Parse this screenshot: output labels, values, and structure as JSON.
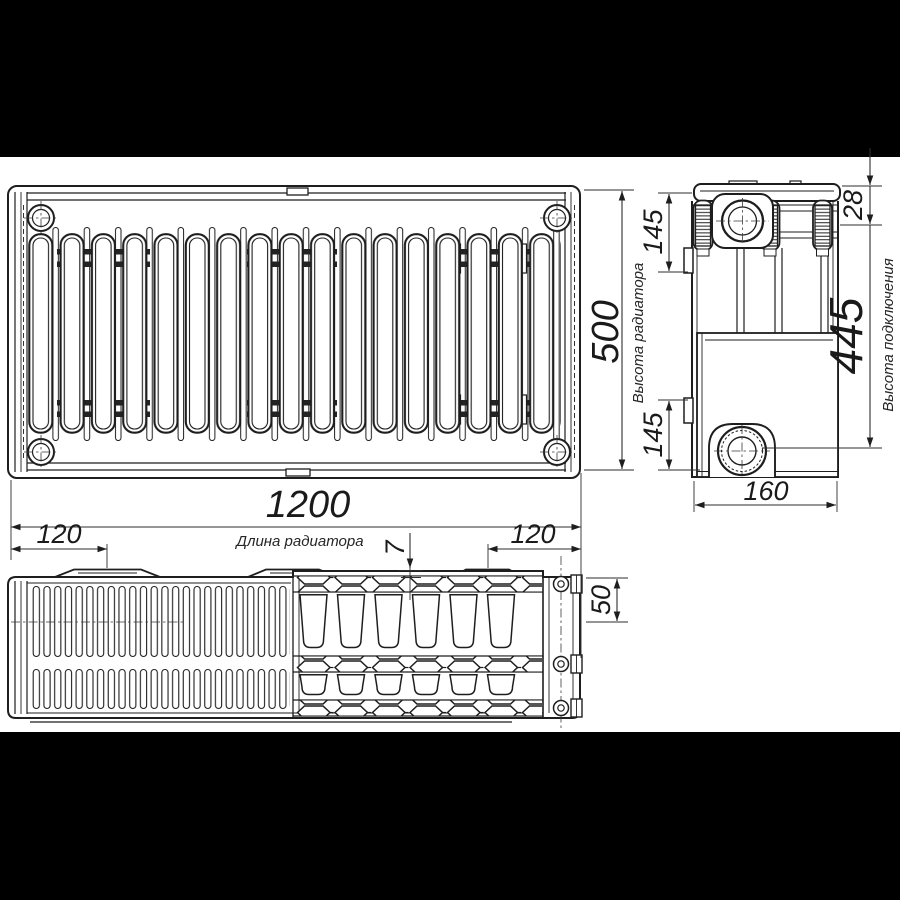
{
  "colors": {
    "backdrop": "#000000",
    "paper": "#ffffff",
    "line": "#1e1e1e"
  },
  "dimensions": {
    "length": "1200",
    "height": "500",
    "depth": "160",
    "connection_height": "445",
    "top_port_offset": "28",
    "bracket_from_top": "145",
    "bracket_from_bottom": "145",
    "bracket_inset_left": "120",
    "bracket_inset_right": "120",
    "grille_step": "7",
    "panel_depth": "50"
  },
  "captions": {
    "height": "Высота радиатора",
    "length": "Длина радиатора",
    "connection": "Высота подключения"
  }
}
